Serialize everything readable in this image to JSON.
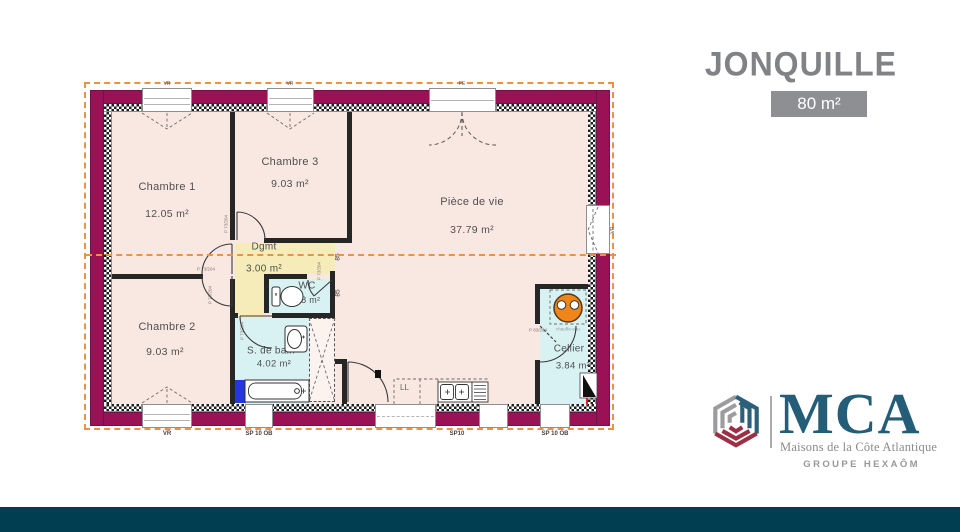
{
  "header": {
    "title": "JONQUILLE",
    "area": "80 m²"
  },
  "brand": {
    "name": "MCA",
    "tagline": "Maisons de la Côte Atlantique",
    "group": "GROUPE HEXAÔM"
  },
  "plan": {
    "rooms": [
      {
        "id": "chambre1",
        "name": "Chambre 1",
        "area": "12.05 m²"
      },
      {
        "id": "chambre3",
        "name": "Chambre 3",
        "area": "9.03 m²"
      },
      {
        "id": "piece_de_vie",
        "name": "Pièce de vie",
        "area": "37.79 m²"
      },
      {
        "id": "dgmt",
        "name": "Dgmt",
        "area": "3.00 m²"
      },
      {
        "id": "wc",
        "name": "WC",
        "area": "1.38 m²"
      },
      {
        "id": "chambre2",
        "name": "Chambre 2",
        "area": "9.03 m²"
      },
      {
        "id": "salle_de_bain",
        "name": "S. de bain",
        "area": "4.02 m²"
      },
      {
        "id": "cellier",
        "name": "Cellier",
        "area": "3.84 m²"
      }
    ],
    "door_refs": {
      "standard": "P 73/204",
      "cellier": "P 83/204"
    },
    "window_labels": {
      "top1": "VR",
      "top2": "VR",
      "entry": "PE",
      "right": "VR",
      "bottom": "VR"
    },
    "sp_labels": {
      "s1": "SP 10 OB",
      "s2": "SP10",
      "s3": "SP 10 OB"
    },
    "dims": {
      "a": "85",
      "b": "85"
    },
    "fixtures": {
      "ll": "LL",
      "tub": "90/190",
      "heater": "chauffe-eau"
    }
  },
  "colors": {
    "wall": "#9b1156",
    "floor": "#f9e8e1",
    "wet_room": "#d8f1f3",
    "hallway": "#f6ecb9",
    "section_line": "#ee9140",
    "title_gray": "#808285",
    "badge_bg": "#8d8f92",
    "brand_teal": "#235d78",
    "footer_bar": "#023e52",
    "cube_gray": "#9c9c9e",
    "cube_teal": "#2d5f79",
    "cube_red": "#9c2f44"
  }
}
